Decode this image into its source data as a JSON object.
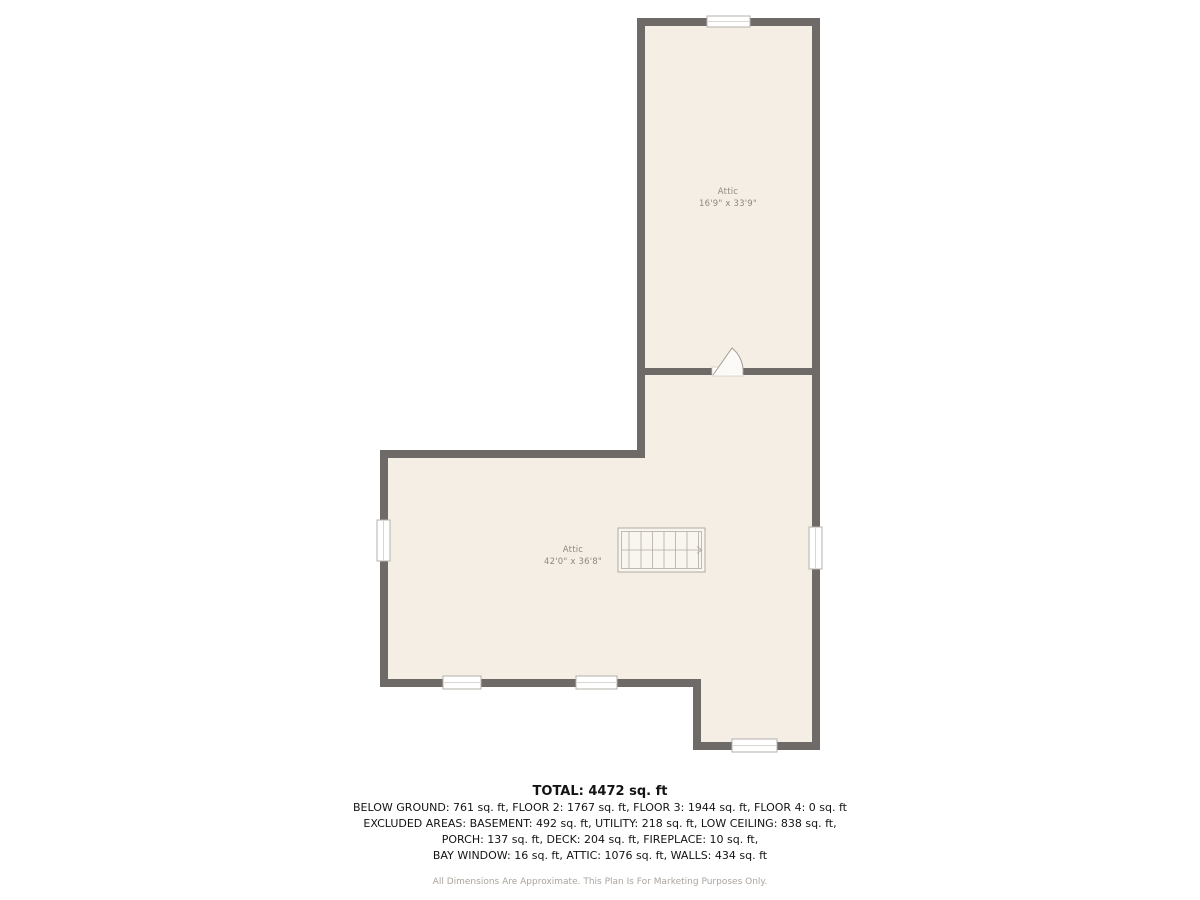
{
  "plan": {
    "rooms": [
      {
        "name": "Attic",
        "dimensions": "16'9\" x 33'9\""
      },
      {
        "name": "Attic",
        "dimensions": "42'0\" x 36'8\""
      }
    ]
  },
  "summary": {
    "total": "TOTAL: 4472 sq. ft",
    "lines": [
      "BELOW GROUND: 761 sq. ft, FLOOR 2: 1767 sq. ft, FLOOR 3: 1944 sq. ft, FLOOR 4: 0 sq. ft",
      "EXCLUDED AREAS: BASEMENT: 492 sq. ft, UTILITY: 218 sq. ft, LOW CEILING: 838 sq. ft,",
      "PORCH: 137 sq. ft, DECK: 204 sq. ft, FIREPLACE: 10 sq. ft,",
      "BAY WINDOW: 16 sq. ft, ATTIC: 1076 sq. ft, WALLS: 434 sq. ft"
    ],
    "disclaimer": "All Dimensions Are Approximate. This Plan Is For Marketing Purposes Only."
  },
  "colors": {
    "wall": "#6e6a68",
    "floor": "#f4eee5",
    "line": "#b2aba3",
    "window_frame": "#b5b0aa",
    "label": "#8e8880",
    "text": "#141414",
    "muted": "#aba49d"
  }
}
